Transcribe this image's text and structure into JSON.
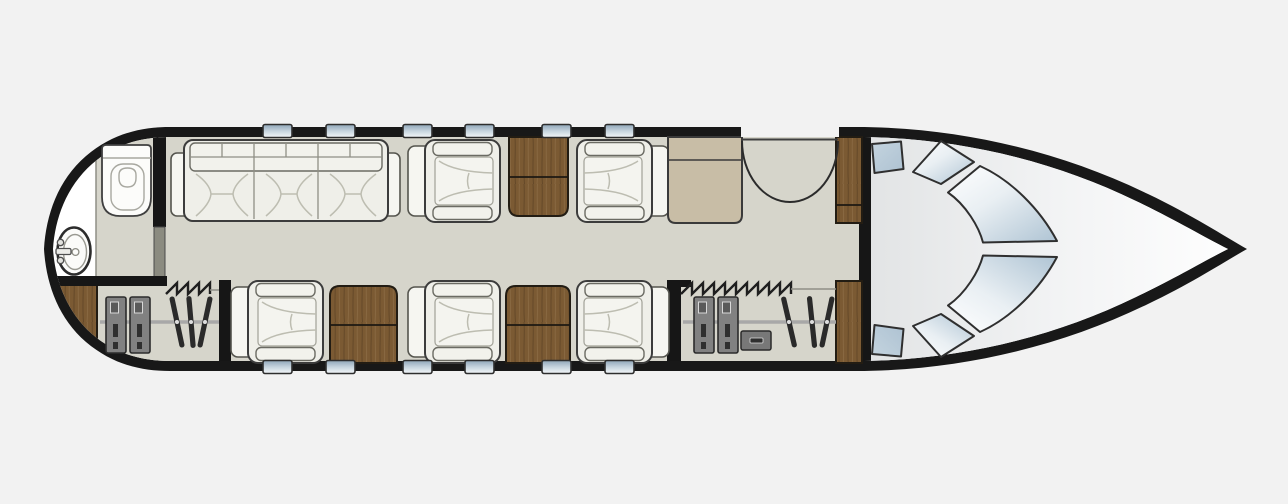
{
  "meta": {
    "title": "Business jet cabin floor plan, top view, nose pointing right",
    "background": "#f2f2f2"
  },
  "colors": {
    "hull_outline": "#181818",
    "cabin_floor": "#d6d5cb",
    "upholstery_white": "#f3f3ee",
    "wood_table_brown": "#7b5a33",
    "galley_cabinet_beige": "#c8bda6",
    "locker_gray": "#818181",
    "glass_blue": "#b3c7d6",
    "wall_black": "#161616",
    "wall_gray": "#8b8b80"
  },
  "windows": {
    "width": 29,
    "height": 13,
    "top_y": 124.5,
    "bottom_y": 360.5,
    "top_x": [
      263,
      326,
      403,
      465,
      542,
      605
    ],
    "bottom_x": [
      263,
      326,
      403,
      465,
      542,
      605
    ]
  },
  "club_seats": [
    {
      "id": "club-seat-1",
      "x": 408,
      "y": 140,
      "facing": "right"
    },
    {
      "id": "club-seat-2",
      "x": 577,
      "y": 140,
      "facing": "left"
    },
    {
      "id": "club-seat-3",
      "x": 231,
      "y": 281,
      "facing": "right"
    },
    {
      "id": "club-seat-4",
      "x": 408,
      "y": 281,
      "facing": "right"
    },
    {
      "id": "club-seat-5",
      "x": 577,
      "y": 281,
      "facing": "left"
    }
  ],
  "furniture": {
    "divan_seats": 3,
    "fold_out_tables": 3,
    "wardrobes": 2,
    "wardrobe_hangers_each": 3,
    "wardrobe_lockers_each": 2,
    "galley_units": 1,
    "aft_cabinets": 2,
    "forward_cabinets": 2,
    "lavatory_fixtures": [
      "toilet",
      "washbasin"
    ],
    "entry_door": "forward, top side, with inward swing arc",
    "curtain_dividers": 2,
    "cockpit_glazing_panels": 6
  }
}
